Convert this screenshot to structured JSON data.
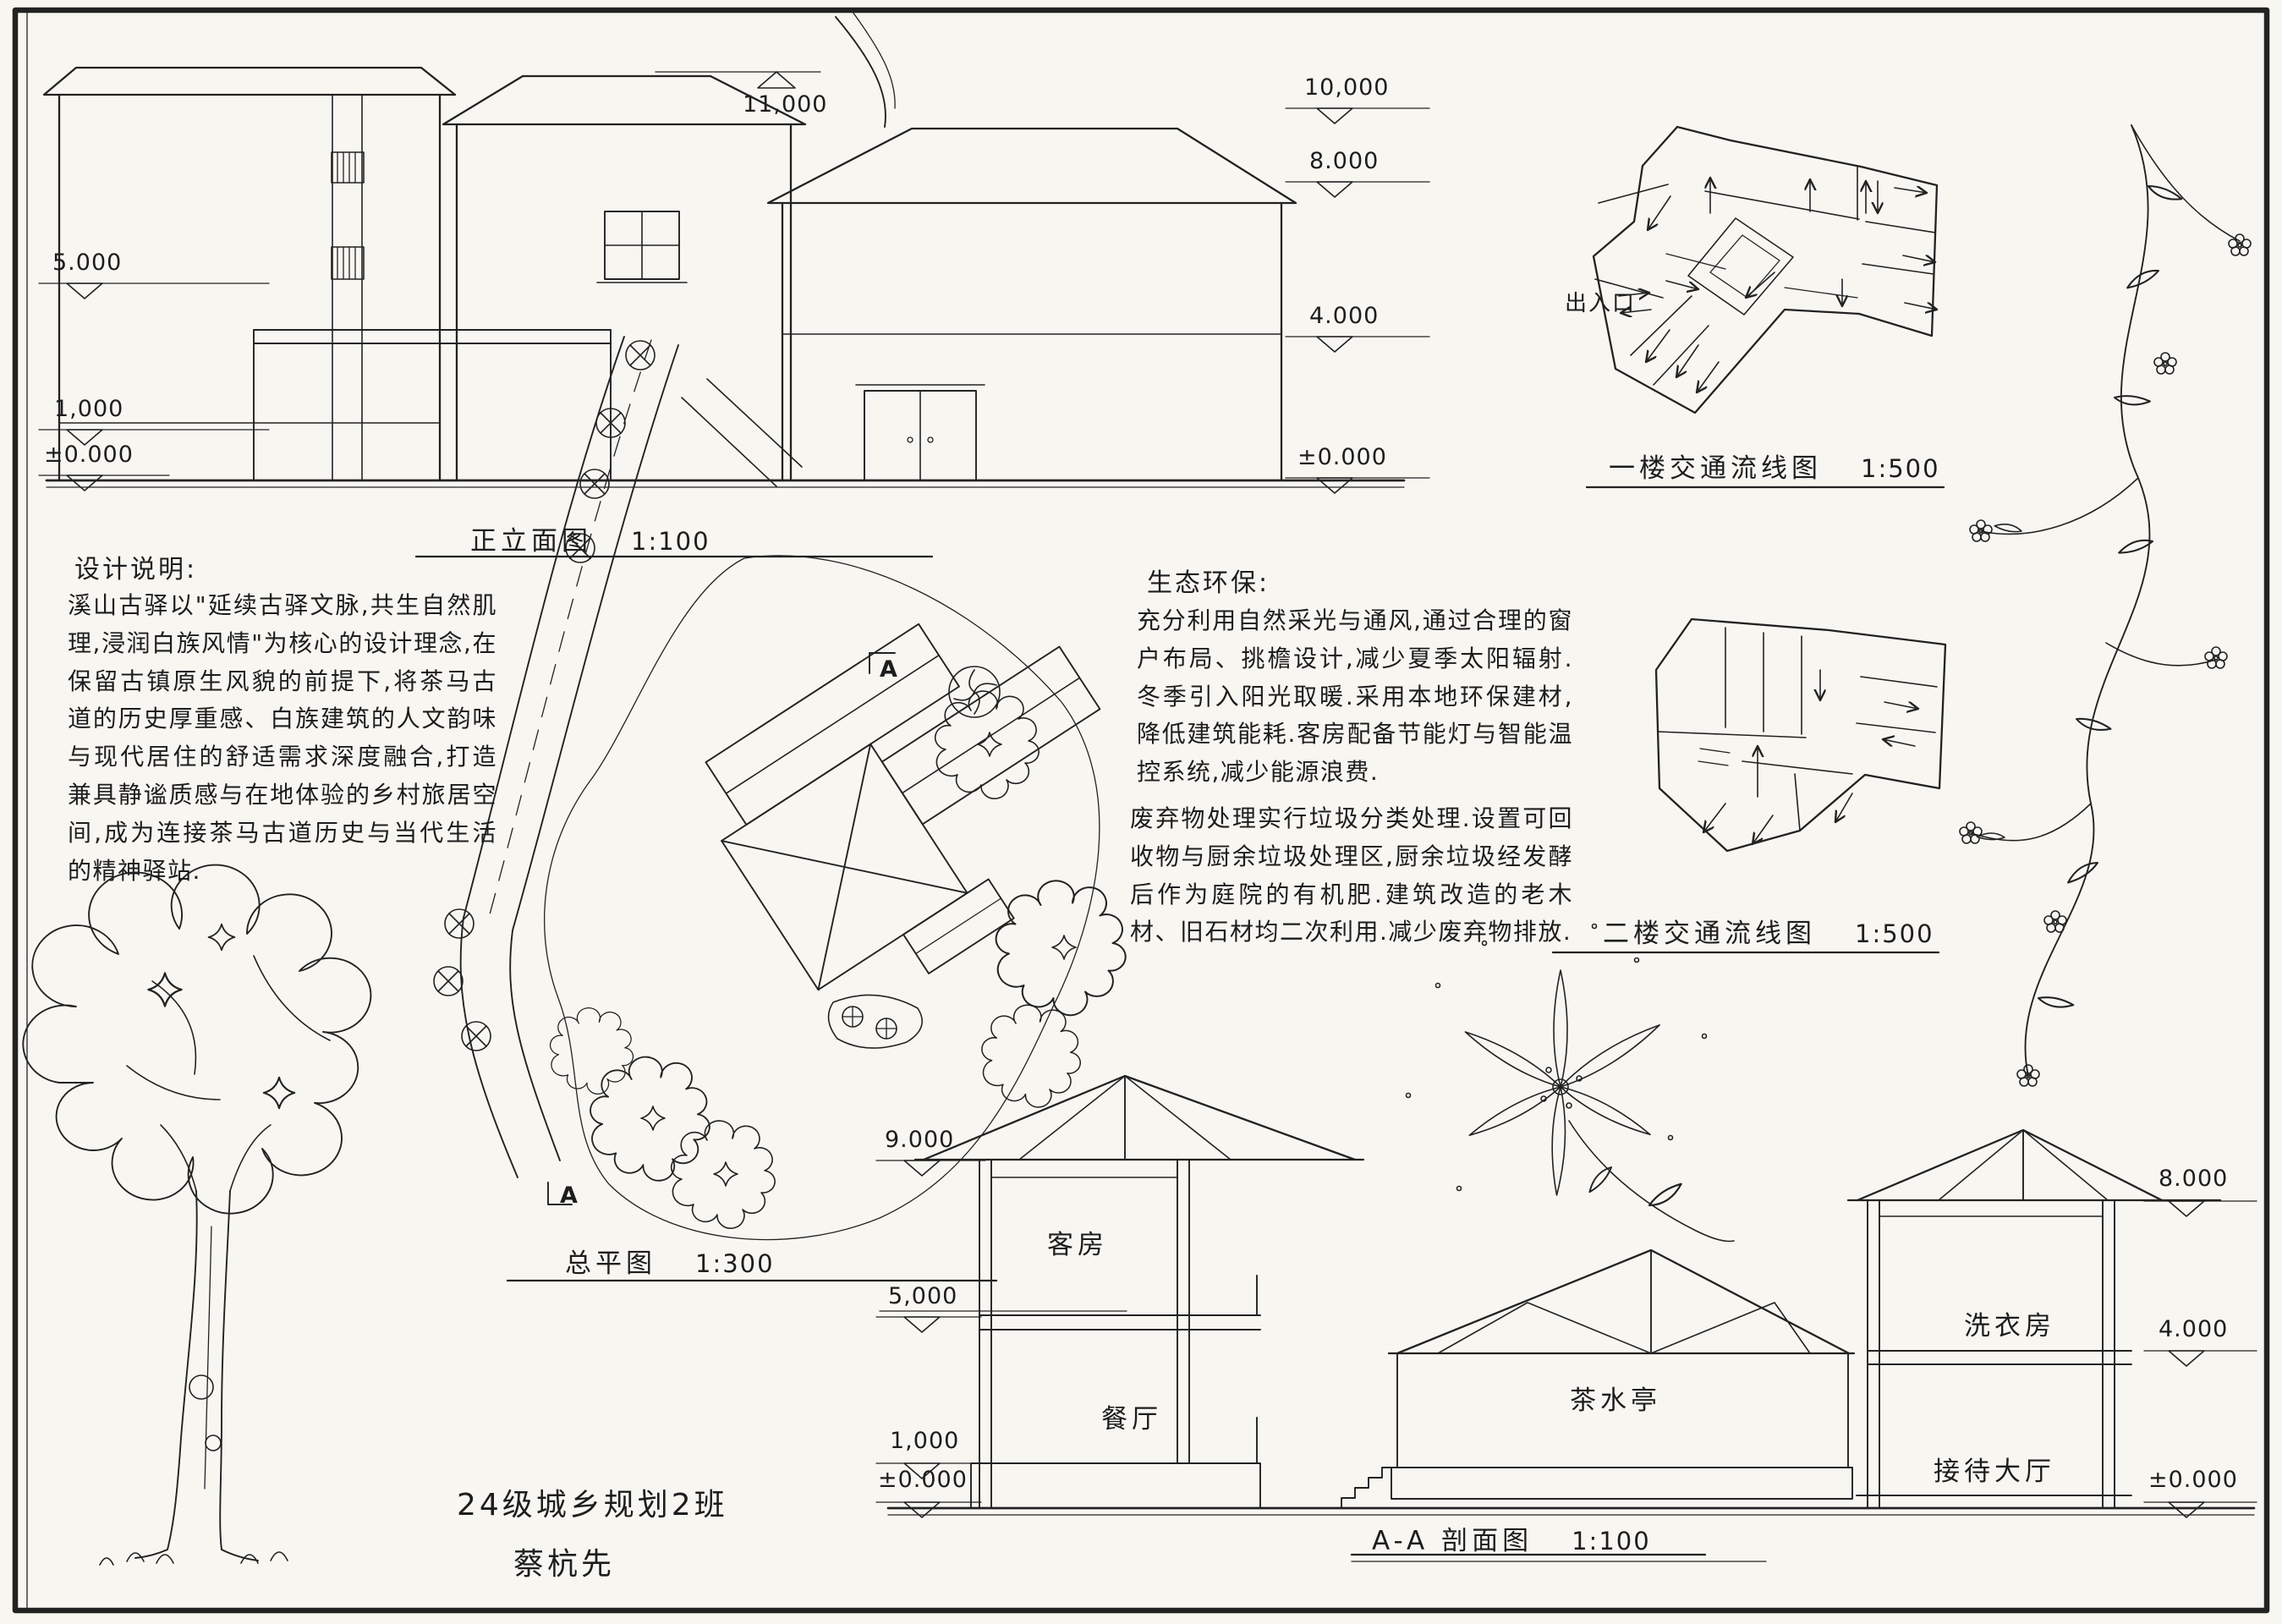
{
  "elevation": {
    "title": "正立面图",
    "scale": "1:100",
    "ridge_mark": "11,000",
    "left_marks": [
      {
        "v": "5.000"
      },
      {
        "v": "1,000"
      },
      {
        "v": "±0.000"
      }
    ],
    "right_marks": [
      {
        "v": "10,000"
      },
      {
        "v": "8.000"
      },
      {
        "v": "4.000"
      },
      {
        "v": "±0.000"
      }
    ]
  },
  "plans": {
    "first": {
      "title": "一楼交通流线图",
      "scale": "1:500",
      "entrance": "出入口"
    },
    "second": {
      "title": "二楼交通流线图",
      "scale": "1:500"
    }
  },
  "site": {
    "title": "总平图",
    "scale": "1:300",
    "section_mark": "A"
  },
  "design_notes": {
    "heading": "设计说明:",
    "body": "溪山古驿以\"延续古驿文脉,共生自然肌理,浸润白族风情\"为核心的设计理念,在保留古镇原生风貌的前提下,将茶马古道的历史厚重感、白族建筑的人文韵味与现代居住的舒适需求深度融合,打造兼具静谧质感与在地体验的乡村旅居空间,成为连接茶马古道历史与当代生活的精神驿站."
  },
  "eco_notes": {
    "heading": "生态环保:",
    "para1": "充分利用自然采光与通风,通过合理的窗户布局、挑檐设计,减少夏季太阳辐射.冬季引入阳光取暖.采用本地环保建材,降低建筑能耗.客房配备节能灯与智能温控系统,减少能源浪费.",
    "para2": "废弃物处理实行垃圾分类处理.设置可回收物与厨余垃圾处理区,厨余垃圾经发酵后作为庭院的有机肥.建筑改造的老木材、旧石材均二次利用.减少废弃物排放."
  },
  "section": {
    "title": "A-A 剖面图",
    "scale": "1:100",
    "left_marks": [
      {
        "v": "9.000"
      },
      {
        "v": "5,000"
      },
      {
        "v": "1,000"
      },
      {
        "v": "±0.000"
      }
    ],
    "right_marks": [
      {
        "v": "8.000"
      },
      {
        "v": "4.000"
      },
      {
        "v": "±0.000"
      }
    ],
    "rooms": {
      "guest": "客房",
      "dining": "餐厅",
      "tea": "茶水亭",
      "laundry": "洗衣房",
      "reception": "接待大厅"
    }
  },
  "signature": {
    "class_line": "24级城乡规划2班",
    "name_line": "蔡杭先"
  }
}
